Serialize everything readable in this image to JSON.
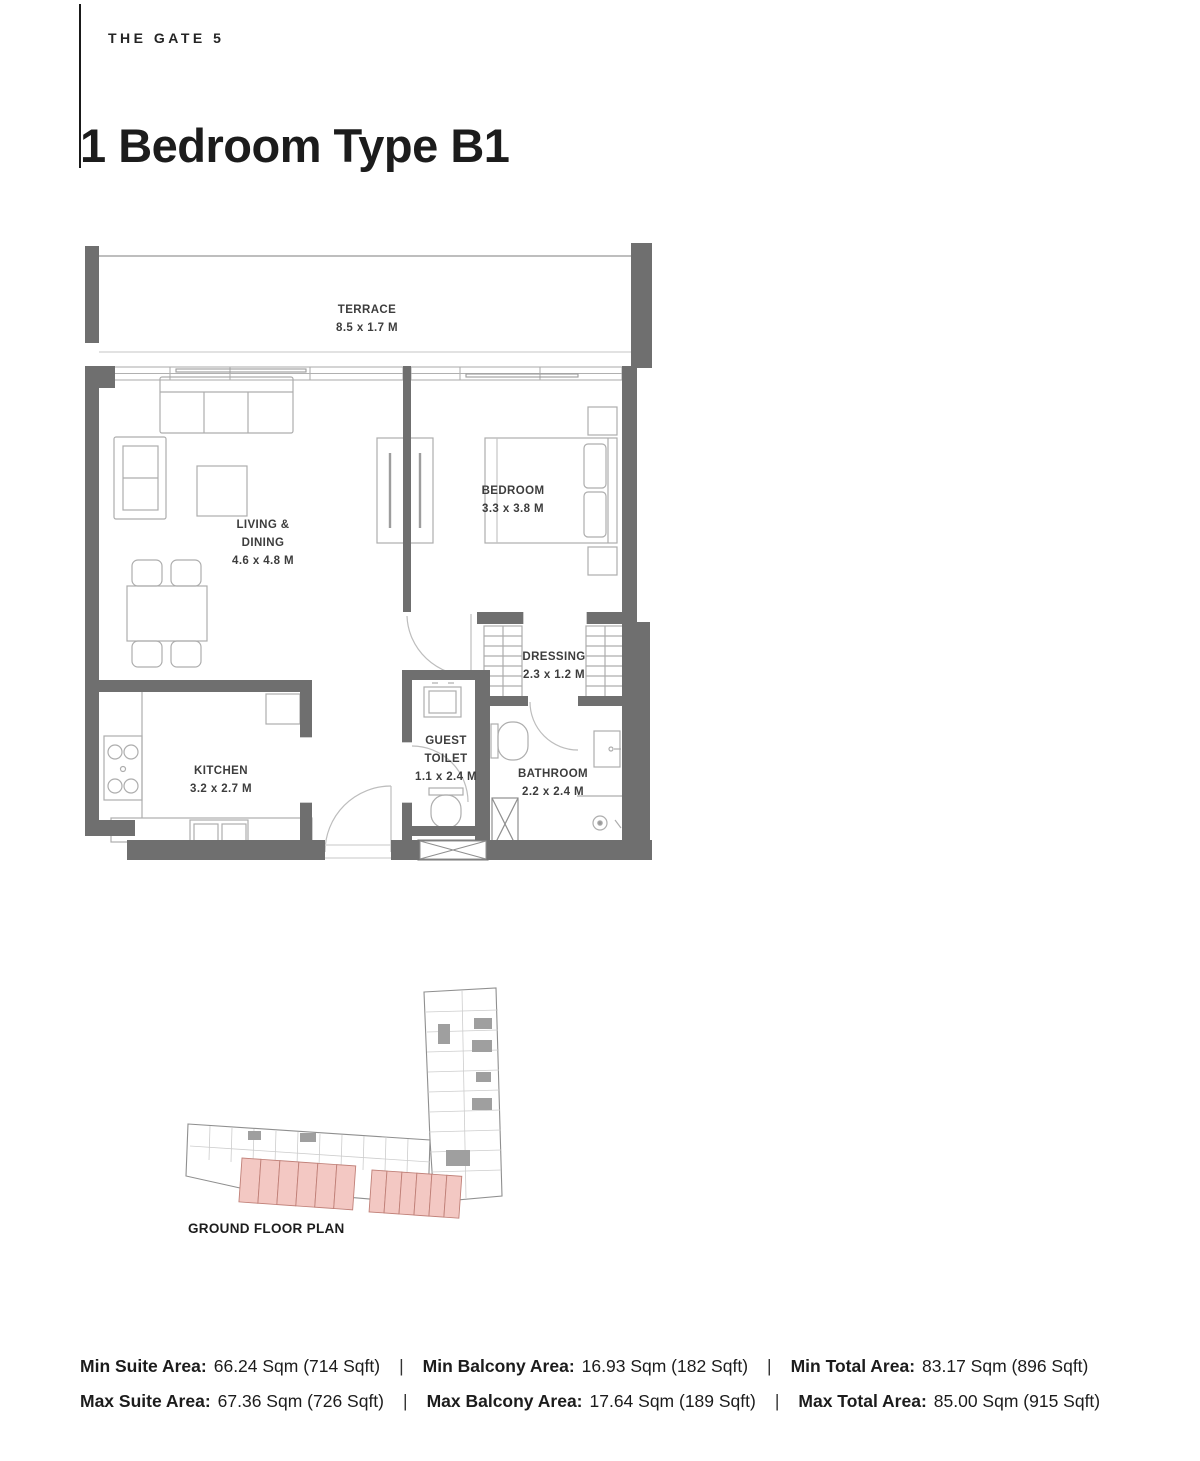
{
  "header": {
    "brand": "THE GATE 5",
    "title": "1 Bedroom Type B1"
  },
  "floor_plan": {
    "rooms": {
      "terrace": {
        "name": "TERRACE",
        "dims": "8.5 x 1.7 M"
      },
      "living": {
        "name_line1": "LIVING &",
        "name_line2": "DINING",
        "dims": "4.6 x 4.8 M"
      },
      "bedroom": {
        "name": "BEDROOM",
        "dims": "3.3 x 3.8 M"
      },
      "dressing": {
        "name": "DRESSING",
        "dims": "2.3 x 1.2 M"
      },
      "guest_toilet": {
        "name_line1": "GUEST",
        "name_line2": "TOILET",
        "dims": "1.1 x 2.4 M"
      },
      "kitchen": {
        "name": "KITCHEN",
        "dims": "3.2 x 2.7 M"
      },
      "bathroom": {
        "name": "BATHROOM",
        "dims": "2.2 x 2.4 M"
      }
    }
  },
  "mini_map": {
    "label": "GROUND FLOOR PLAN"
  },
  "areas": {
    "separator": "|",
    "rows": [
      {
        "items": [
          {
            "label": "Min Suite Area:",
            "value": "66.24 Sqm (714 Sqft)"
          },
          {
            "label": "Min Balcony Area:",
            "value": "16.93 Sqm (182 Sqft)"
          },
          {
            "label": "Min Total Area:",
            "value": "83.17 Sqm (896 Sqft)"
          }
        ]
      },
      {
        "items": [
          {
            "label": "Max Suite Area:",
            "value": "67.36 Sqm (726 Sqft)"
          },
          {
            "label": "Max Balcony Area:",
            "value": "17.64 Sqm (189 Sqft)"
          },
          {
            "label": "Max Total Area:",
            "value": "85.00 Sqm (915 Sqft)"
          }
        ]
      }
    ]
  },
  "colors": {
    "wall": "#6f6f6f",
    "thin_line": "#b0b0b0",
    "unit_highlight": "#f3c8c3",
    "unit_highlight_stroke": "#c08078"
  }
}
